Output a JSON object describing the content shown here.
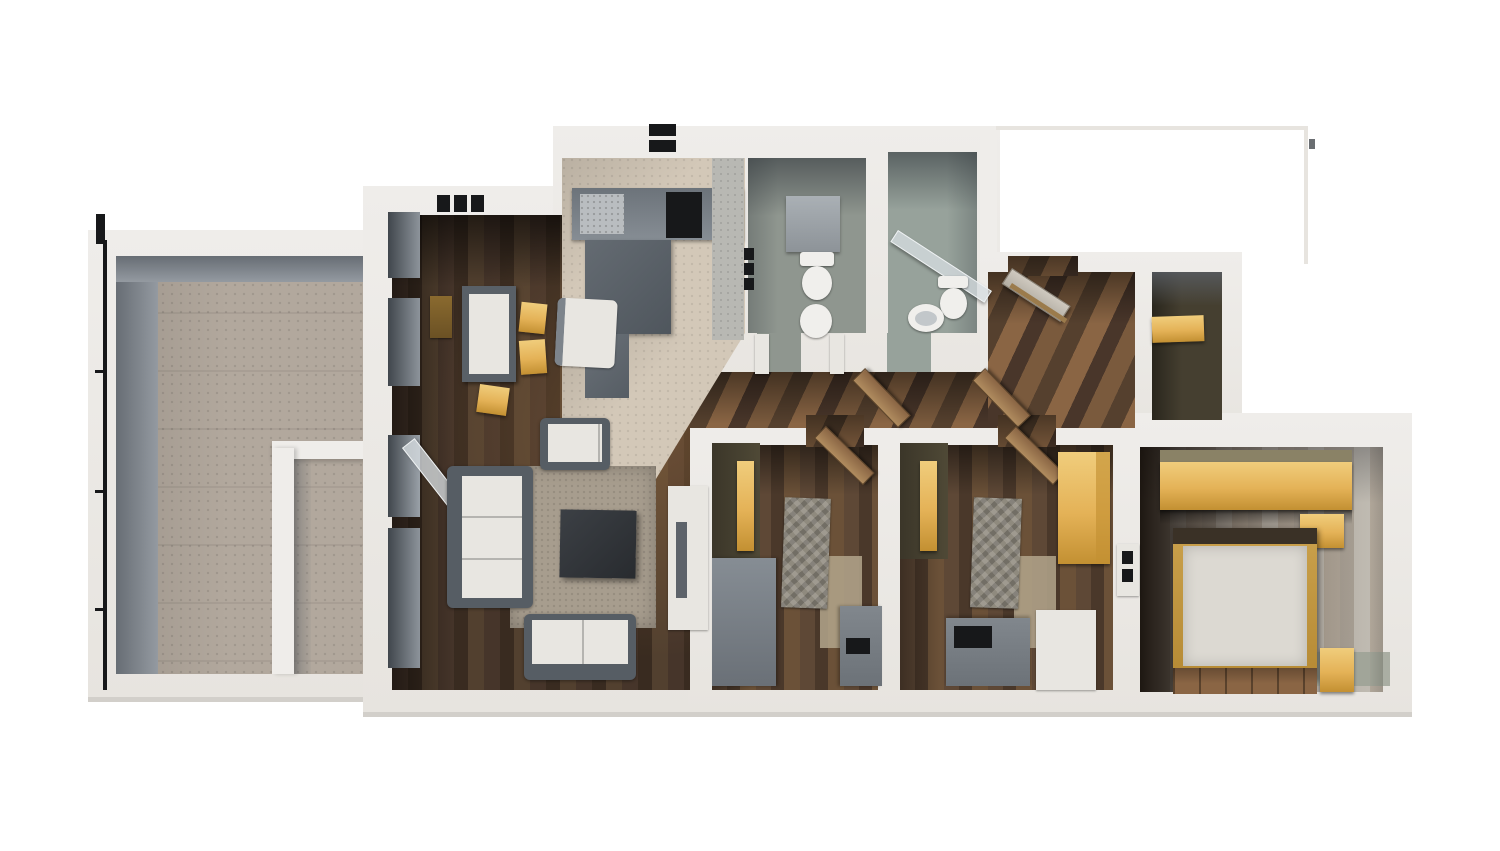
{
  "scene": {
    "title": "3D rendered apartment floor plan, top-down view",
    "background": "#ffffff"
  },
  "palette": {
    "bg": "#ffffff",
    "wall": "#efedea",
    "wallWarm": "#e7e4df",
    "wallShade": "#d2cfca",
    "wallFace": "#949aa1",
    "wallFaceDark": "#676d74",
    "woodDark": "#3a2c21",
    "woodMid": "#5c4331",
    "woodLight": "#8a6544",
    "woodPale": "#b08c5f",
    "terraceFloor": "#b2a89d",
    "tileFloor": "#d3c8b8",
    "bathFloorA": "#8f968f",
    "bathFloorB": "#97a29b",
    "masterLight": "#cfccc4",
    "oliveDark": "#453f30",
    "accentYellow": "#e4b257",
    "accentYellowLight": "#f0cd7c",
    "accentYellowDark": "#c39032",
    "furnWhite": "#e8e6e1",
    "furnGray": "#7d848b",
    "furnGrayDark": "#565d64",
    "deskGray": "#81878d",
    "blanket": "#8f8a7e",
    "rug": "#a79d8e",
    "rugGreen": "#9aa094",
    "mattress": "#dcd9d2",
    "ceramic": "#f0efec",
    "black": "#17181a"
  },
  "rooms": {
    "terrace": {
      "name": "Terrace"
    },
    "living": {
      "name": "Living room"
    },
    "dining": {
      "name": "Dining area"
    },
    "kitchen": {
      "name": "Kitchen"
    },
    "wc": {
      "name": "WC"
    },
    "bathroom": {
      "name": "Bathroom"
    },
    "hallway": {
      "name": "Hallway"
    },
    "entry": {
      "name": "Entry hall"
    },
    "storage": {
      "name": "Storage room"
    },
    "bedroom1": {
      "name": "Bedroom 1"
    },
    "bedroom2": {
      "name": "Bedroom 2"
    },
    "master": {
      "name": "Master bedroom"
    }
  },
  "furniture": {
    "sofa": "Sofa",
    "loveseat": "Loveseat",
    "armchair": "Armchair",
    "coffee_table": "Coffee table",
    "dining_table": "Dining table",
    "dining_chair": "Dining chair",
    "tv_stand": "TV cabinet",
    "kitchen_counter": "Kitchen counter",
    "kitchen_island": "Kitchen cabinets",
    "cooktop": "Cooktop",
    "sink": "Sink",
    "toilet": "Toilet",
    "bidet": "Bidet",
    "shower": "Shower glass panel",
    "washbasin": "Washbasin",
    "bed_single": "Single bed",
    "bed_double": "Double bed",
    "desk": "Desk",
    "wardrobe": "Wardrobe",
    "nightstand": "Nightstand",
    "shelf": "Shelf",
    "front_door": "Front door (open)",
    "interior_door": "Interior door (open)",
    "railing": "Terrace railing",
    "vent": "Wall vent",
    "chimney": "Chimney vent"
  }
}
